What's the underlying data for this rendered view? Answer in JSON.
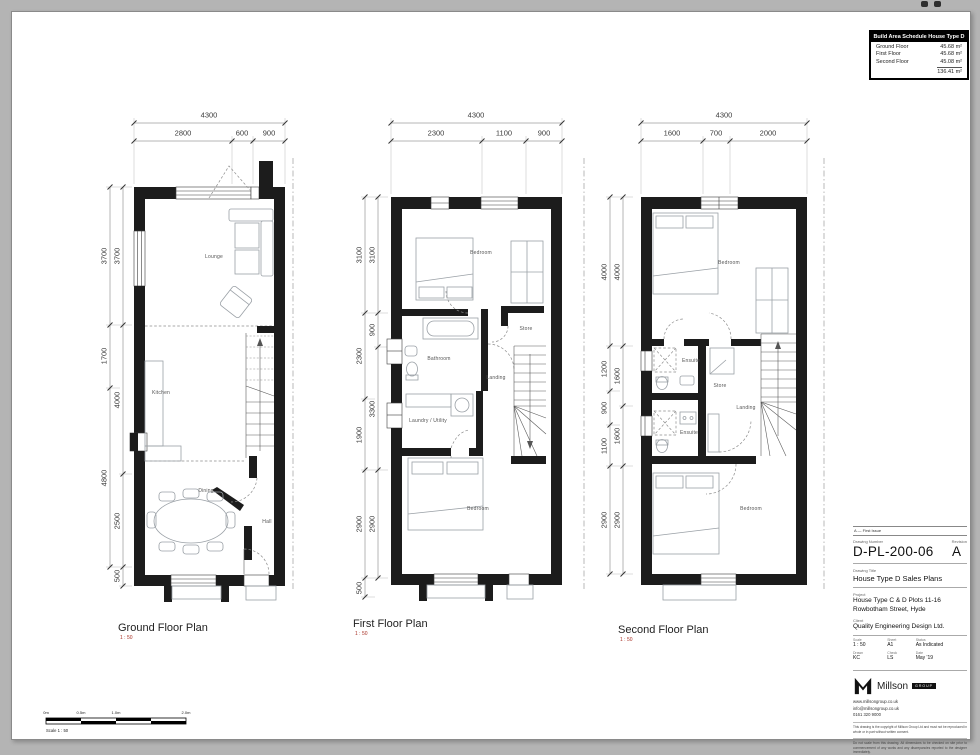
{
  "schedule": {
    "title": "Build Area Schedule House Type D",
    "rows": [
      {
        "label": "Ground Floor",
        "value": "45.68 m²"
      },
      {
        "label": "First Floor",
        "value": "45.68 m²"
      },
      {
        "label": "Second Floor",
        "value": "45.08 m²"
      }
    ],
    "total": "136.41 m²"
  },
  "plans": [
    {
      "title": "Ground Floor Plan",
      "scale_label": "1 : 50",
      "dims": {
        "total": "4300",
        "top": [
          "2800",
          "600",
          "900"
        ],
        "left_outer": [
          "3700",
          "1700",
          "4800"
        ],
        "left_inner": [
          "3700",
          "4000",
          "2500",
          "500"
        ]
      },
      "rooms": [
        "Lounge",
        "Kitchen",
        "Dining",
        "Hall"
      ]
    },
    {
      "title": "First Floor Plan",
      "scale_label": "1 : 50",
      "dims": {
        "total": "4300",
        "top": [
          "2300",
          "1100",
          "900"
        ],
        "left_outer": [
          "3100",
          "2300",
          "1900",
          "2900",
          "500"
        ],
        "left_inner": [
          "3100",
          "900",
          "3300",
          "2900"
        ]
      },
      "rooms": [
        "Bedroom",
        "Bathroom",
        "Store",
        "Landing",
        "Laundry / Utility",
        "Bedroom"
      ]
    },
    {
      "title": "Second Floor Plan",
      "scale_label": "1 : 50",
      "dims": {
        "total": "4300",
        "top": [
          "1600",
          "700",
          "2000"
        ],
        "left_outer": [
          "4000",
          "1200",
          "900",
          "1100",
          "2900"
        ],
        "left_inner": [
          "4000",
          "1600",
          "1600",
          "2900"
        ]
      },
      "rooms": [
        "Bedroom",
        "Ensuite",
        "Store",
        "Landing",
        "Ensuite",
        "Bedroom"
      ]
    }
  ],
  "title_block": {
    "rev_note": "A — First Issue",
    "labels": {
      "number": "Drawing Number",
      "revision": "Revision",
      "title": "Drawing Title",
      "project": "Project",
      "client": "Client",
      "scale": "Scale",
      "sheet": "Sheet",
      "status": "Status",
      "drawn": "Drawn",
      "checked": "Check",
      "date": "Date"
    },
    "number": "D-PL-200-06",
    "revision": "A",
    "title": "House Type D Sales Plans",
    "project_line1": "House Type C & D Plots 11-16",
    "project_line2": "Rowbotham Street, Hyde",
    "client": "Quality Engineering Design Ltd.",
    "scale": "1 : 50",
    "sheet": "A1",
    "status": "As Indicated",
    "drawn": "KC",
    "checked": "LS",
    "date": "May '19",
    "logo_name": "Millson",
    "logo_sub": "GROUP",
    "contact1": "www.millsongroup.co.uk",
    "contact2": "info@millsongroup.co.uk",
    "contact3": "0161 320 9000",
    "disclaimer1": "This drawing is the copyright of Millson Group Ltd and must not be reproduced in whole or in part without written consent.",
    "disclaimer2": "Do not scale from this drawing. All dimensions to be checked on site prior to commencement of any works and any discrepancies reported to the designer immediately."
  },
  "scale_bar": {
    "labels": [
      "0m",
      "0.5m",
      "1.0m",
      "2.0m"
    ],
    "caption": "Scale 1 : 50"
  }
}
